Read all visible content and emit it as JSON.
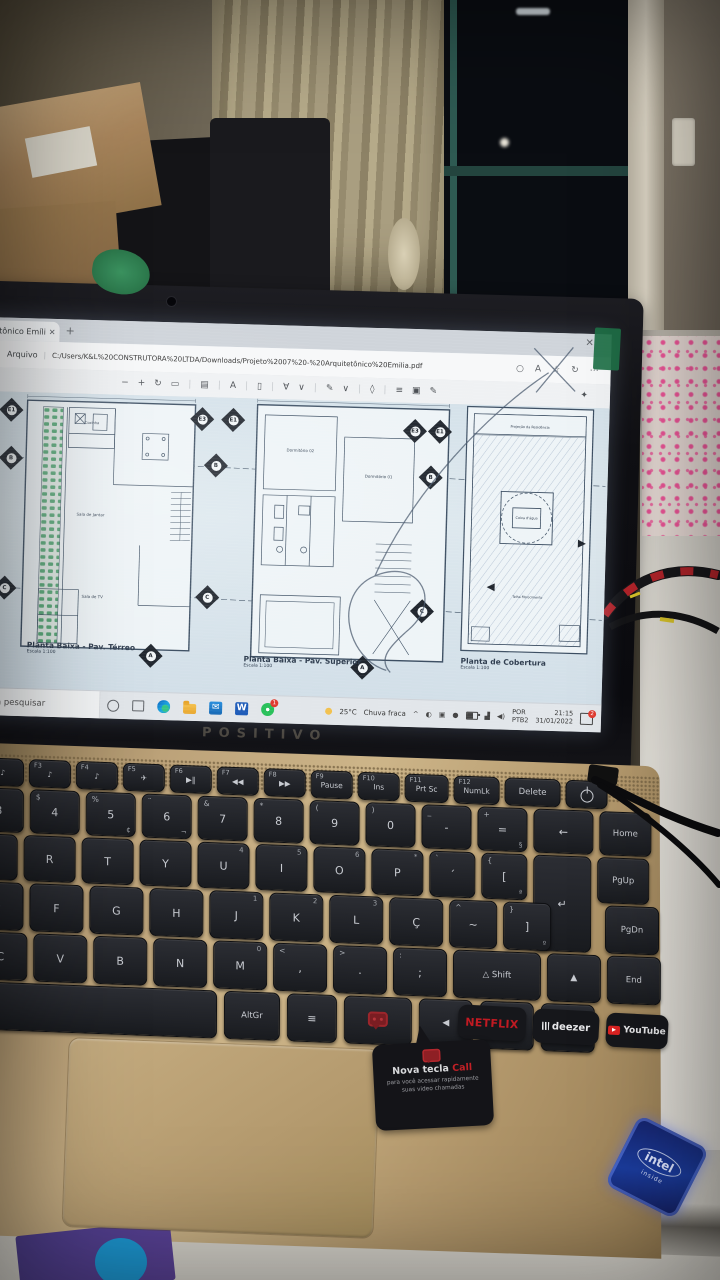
{
  "browser": {
    "tab": {
      "title": "tetônico Emíli",
      "close_glyph": "✕",
      "new_tab_glyph": "+"
    },
    "window_close_glyph": "✕",
    "menu": {
      "file": "Arquivo"
    },
    "address": "C:/Users/K&L%20CONSTRUTORA%20LTDA/Downloads/Projeto%2007%20-%20Arquitetônico%20Emilia.pdf",
    "address_icons": [
      {
        "name": "zoom-icon",
        "glyph": "○"
      },
      {
        "name": "read-aloud-icon",
        "glyph": "A"
      },
      {
        "name": "favorites-icon",
        "glyph": "☆"
      },
      {
        "name": "sync-icon",
        "glyph": "↻"
      },
      {
        "name": "more-icon",
        "glyph": "⋯"
      }
    ],
    "pdf_toolbar": [
      {
        "name": "zoom-out-icon",
        "glyph": "−"
      },
      {
        "name": "zoom-in-icon",
        "glyph": "+"
      },
      {
        "name": "rotate-icon",
        "glyph": "↻"
      },
      {
        "name": "fit-page-icon",
        "glyph": "▭"
      },
      {
        "name": "divider",
        "glyph": "|"
      },
      {
        "name": "page-view-icon",
        "glyph": "▤"
      },
      {
        "name": "divider",
        "glyph": "|"
      },
      {
        "name": "read-aloud-icon",
        "glyph": "A"
      },
      {
        "name": "divider",
        "glyph": "|"
      },
      {
        "name": "text-select-icon",
        "glyph": "▯"
      },
      {
        "name": "divider",
        "glyph": "|"
      },
      {
        "name": "draw-icon",
        "glyph": "∀"
      },
      {
        "name": "draw-caret-icon",
        "glyph": "∨"
      },
      {
        "name": "divider",
        "glyph": "|"
      },
      {
        "name": "highlight-icon",
        "glyph": "✎"
      },
      {
        "name": "highlight-caret-icon",
        "glyph": "∨"
      },
      {
        "name": "divider",
        "glyph": "|"
      },
      {
        "name": "erase-icon",
        "glyph": "◊"
      },
      {
        "name": "divider",
        "glyph": "|"
      },
      {
        "name": "print-icon",
        "glyph": "≡"
      },
      {
        "name": "save-icon",
        "glyph": "▣"
      },
      {
        "name": "save-as-icon",
        "glyph": "✎"
      }
    ],
    "pin_glyph": "✦"
  },
  "pdf": {
    "plans": [
      {
        "title": "Planta Baixa - Pav. Térreo",
        "scale": "Escala 1:100"
      },
      {
        "title": "Planta Baixa - Pav. Superior",
        "scale": "Escala 1:100"
      },
      {
        "title": "Planta de Cobertura",
        "scale": "Escala 1:100"
      }
    ],
    "markers": {
      "e1": "E1",
      "e3": "E3",
      "b": "B",
      "c": "C",
      "a": "A"
    },
    "room_labels": {
      "sala_jantar": "Sala de Jantar",
      "sala_tv": "Sala de TV",
      "cozinha": "Cozinha",
      "dorm2": "Dormitório 02",
      "dorm1": "Dormitório 01",
      "proj": "Projeção da Residência",
      "caixa": "Caixa d'água",
      "telha": "Telha Fibrocimento"
    }
  },
  "taskbar": {
    "search_text": "ara pesquisar",
    "weather_temp": "25°C",
    "weather_desc": "Chuva fraca",
    "tray_caret": "^",
    "lang1": "POR",
    "lang2": "PTB2",
    "time": "21:15",
    "date": "31/01/2022",
    "wapp_badge": "1",
    "notif_badge": "2",
    "word_letter": "W",
    "mail_glyph": "✉"
  },
  "laptop": {
    "brand": "POSITIVO",
    "stickers": {
      "netflix": "NETFLIX",
      "deezer": "deezer",
      "youtube": "YouTube",
      "call_prefix": "Nova tecla ",
      "call_word": "Call",
      "call_sub": "para você acessar rapidamente suas video chamadas",
      "intel_name": "intel",
      "intel_sub": "inside"
    },
    "colors": {
      "netflix_red": "#c11a22",
      "call_red": "#c32026",
      "intel_blue": "#1b3c9e",
      "deck_gold": "#bca279"
    }
  },
  "kb": {
    "rows": [
      {
        "top": 758,
        "left": -18,
        "h": 26,
        "gap": 5,
        "w": 40,
        "cls": "fn",
        "keys": [
          {
            "s": "F2",
            "m": "♪",
            "n": "f2-key"
          },
          {
            "s": "F3",
            "m": "♪",
            "n": "f3-key"
          },
          {
            "s": "F4",
            "m": "♪",
            "n": "f4-key"
          },
          {
            "s": "F5",
            "m": "✈",
            "n": "f5-key"
          },
          {
            "s": "F6",
            "m": "▶‖",
            "n": "f6-key"
          },
          {
            "s": "F7",
            "m": "◀◀",
            "n": "f7-key"
          },
          {
            "s": "F8",
            "m": "▶▶",
            "n": "f8-key"
          },
          {
            "s": "F9",
            "m": "Pause",
            "n": "f9-key"
          },
          {
            "s": "F10",
            "m": "Ins",
            "n": "f10-key"
          },
          {
            "s": "F11",
            "m": "Prt Sc",
            "w": 42,
            "n": "f11-key"
          },
          {
            "s": "F12",
            "m": "NumLk",
            "w": 44,
            "n": "f12-key"
          },
          {
            "m": "Delete",
            "w": 54,
            "cls": "small",
            "n": "delete-key"
          },
          {
            "m": "",
            "cls": "power",
            "w": 40,
            "n": "power-key"
          }
        ]
      },
      {
        "top": 788,
        "left": -26,
        "h": 42,
        "gap": 6,
        "w": 48,
        "keys": [
          {
            "s": "#",
            "m": "3",
            "n": "key-3"
          },
          {
            "s": "$",
            "m": "4",
            "n": "key-4"
          },
          {
            "s": "%",
            "m": "5",
            "x": "¢",
            "n": "key-5"
          },
          {
            "s": "¨",
            "m": "6",
            "x": "¬",
            "n": "key-6"
          },
          {
            "s": "&",
            "m": "7",
            "n": "key-7"
          },
          {
            "s": "*",
            "m": "8",
            "n": "key-8"
          },
          {
            "s": "(",
            "m": "9",
            "n": "key-9"
          },
          {
            "s": ")",
            "m": "0",
            "n": "key-0"
          },
          {
            "s": "_",
            "m": "-",
            "n": "key-minus"
          },
          {
            "s": "+",
            "m": "=",
            "x": "§",
            "n": "key-equals"
          },
          {
            "m": "←",
            "w": 58,
            "n": "backspace-key"
          },
          {
            "m": "Home",
            "w": 50,
            "cls": "small",
            "n": "home-key"
          }
        ]
      },
      {
        "top": 834,
        "left": -34,
        "h": 44,
        "gap": 6,
        "w": 50,
        "keys": [
          {
            "m": "E",
            "n": "key-e"
          },
          {
            "m": "R",
            "n": "key-r"
          },
          {
            "m": "T",
            "n": "key-t"
          },
          {
            "m": "Y",
            "n": "key-y"
          },
          {
            "m": "U",
            "e": "4",
            "n": "key-u"
          },
          {
            "m": "I",
            "e": "5",
            "n": "key-i"
          },
          {
            "m": "O",
            "e": "6",
            "n": "key-o"
          },
          {
            "m": "P",
            "e": "*",
            "n": "key-p"
          },
          {
            "s": "`",
            "m": "´",
            "w": 44,
            "n": "key-acute"
          },
          {
            "s": "{",
            "m": "[",
            "x": "ª",
            "w": 44,
            "n": "key-bracket-open"
          },
          {
            "m": "↵",
            "w": 56,
            "cls": "enter",
            "n": "enter-key"
          },
          {
            "m": "PgUp",
            "w": 50,
            "cls": "small",
            "n": "pgup-key"
          }
        ]
      },
      {
        "top": 882,
        "left": -30,
        "h": 46,
        "gap": 6,
        "w": 52,
        "keys": [
          {
            "m": "D",
            "n": "key-d"
          },
          {
            "m": "F",
            "n": "key-f"
          },
          {
            "m": "G",
            "n": "key-g"
          },
          {
            "m": "H",
            "n": "key-h"
          },
          {
            "m": "J",
            "e": "1",
            "n": "key-j"
          },
          {
            "m": "K",
            "e": "2",
            "n": "key-k"
          },
          {
            "m": "L",
            "e": "3",
            "n": "key-l"
          },
          {
            "m": "Ç",
            "n": "key-cedilla"
          },
          {
            "s": "^",
            "m": "~",
            "w": 46,
            "n": "key-tilde"
          },
          {
            "s": "}",
            "m": "]",
            "x": "º",
            "w": 46,
            "n": "key-bracket-close"
          },
          {
            "m": "",
            "cls": "ghost",
            "w": 40,
            "n": "spacer"
          },
          {
            "m": "PgDn",
            "w": 52,
            "cls": "small",
            "n": "pgdn-key"
          }
        ]
      },
      {
        "top": 932,
        "left": -26,
        "h": 46,
        "gap": 6,
        "w": 52,
        "keys": [
          {
            "m": "C",
            "n": "key-c"
          },
          {
            "m": "V",
            "n": "key-v"
          },
          {
            "m": "B",
            "n": "key-b"
          },
          {
            "m": "N",
            "n": "key-n"
          },
          {
            "m": "M",
            "e": "0",
            "n": "key-m"
          },
          {
            "s": "<",
            "m": ",",
            "n": "key-comma"
          },
          {
            "s": ">",
            "m": ".",
            "n": "key-period"
          },
          {
            "s": ":",
            "m": ";",
            "n": "key-semicolon"
          },
          {
            "m": "△ Shift",
            "w": 86,
            "cls": "small",
            "n": "shift-key"
          },
          {
            "m": "▲",
            "cls": "arrow",
            "n": "arrow-up-key"
          },
          {
            "m": "End",
            "w": 52,
            "cls": "small",
            "n": "end-key"
          }
        ]
      },
      {
        "top": 982,
        "left": -40,
        "h": 46,
        "gap": 7,
        "w": 52,
        "keys": [
          {
            "m": "",
            "cls": "space",
            "w": 256,
            "n": "spacebar"
          },
          {
            "m": "AltGr",
            "w": 54,
            "cls": "small",
            "n": "altgr-key"
          },
          {
            "m": "≡",
            "w": 48,
            "n": "menu-key"
          },
          {
            "m": "",
            "cls": "call",
            "w": 66,
            "n": "call-key"
          },
          {
            "m": "◀",
            "cls": "arrow",
            "n": "arrow-left-key"
          },
          {
            "m": "▼",
            "cls": "arrow",
            "n": "arrow-down-key"
          },
          {
            "m": "▶",
            "cls": "arrow",
            "n": "arrow-right-key"
          }
        ]
      }
    ]
  }
}
